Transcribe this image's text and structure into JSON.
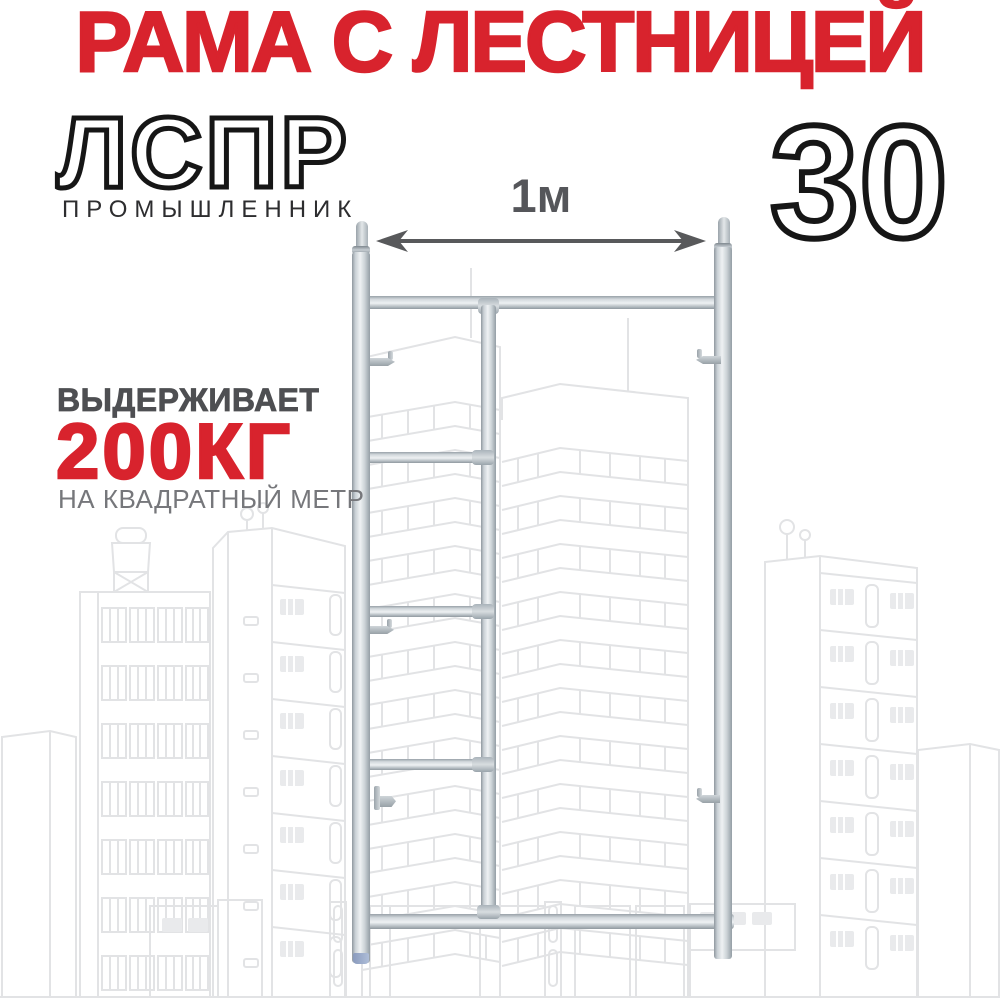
{
  "header": {
    "title": "РАМА С ЛЕСТНИЦЕЙ",
    "model": "ЛСПР",
    "brand": "ПРОМЫШЛЕННИК",
    "size_number": "30"
  },
  "dimension": {
    "width_label": "1м"
  },
  "load": {
    "intro": "ВЫДЕРЖИВАЕТ",
    "value": "200КГ",
    "per_unit": "НА КВАДРАТНЫЙ МЕТР"
  },
  "product": {
    "depicts": "galvanized scaffolding frame with ladder",
    "rung_count": 3
  },
  "colors": {
    "accent_red": "#d8232d",
    "outline_black": "#161616",
    "brand_gray": "#2d2d2f",
    "text_dark_gray": "#4e4f52",
    "text_mid_gray": "#55565a",
    "text_light_gray": "#76777b",
    "city_line": "#e2e3e5",
    "city_window_fill": "#e9eaec",
    "metal_cap_blue": "#8a9bbd",
    "arrow_gray": "#58595b"
  }
}
